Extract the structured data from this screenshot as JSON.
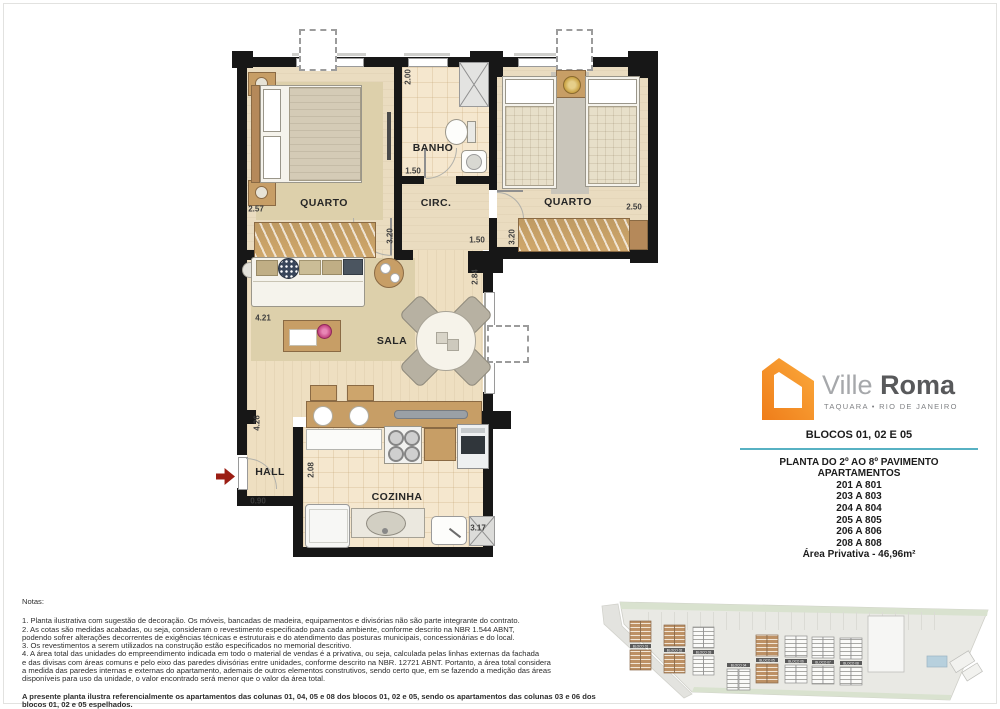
{
  "plan": {
    "rooms": {
      "quarto1": "QUARTO",
      "banho": "BANHO",
      "circ": "CIRC.",
      "quarto2": "QUARTO",
      "sala": "SALA",
      "hall": "HALL",
      "cozinha": "COZINHA"
    },
    "dims": {
      "q1_w": "2.57",
      "q1_h": "3.20",
      "banho_h": "2.00",
      "banho_w": "1.50",
      "circ_w": "1.50",
      "q2_w": "2.50",
      "q2_h": "3.20",
      "sala_h": "2.84",
      "sala_w": "4.21",
      "sala_left_h": "4.26",
      "hall_w": "0.90",
      "coz_h": "2.08",
      "coz_w": "3.17"
    }
  },
  "brand": {
    "name_light": "Ville",
    "name_bold": "Roma",
    "tagline": "TAQUARA • RIO DE JANEIRO",
    "logo_color": "#f6881f"
  },
  "info": {
    "blocks_title": "BLOCOS 01, 02 E 05",
    "accent_color": "#57b1c3",
    "title": "PLANTA DO 2º AO 8º PAVIMENTO",
    "subtitle": "APARTAMENTOS",
    "units": [
      "201 A 801",
      "203 A 803",
      "204 A 804",
      "205 A 805",
      "206 A 806",
      "208 A 808"
    ],
    "area": "Área Privativa - 46,96m²"
  },
  "notes": {
    "heading": "Notas:",
    "lines": [
      "1. Planta ilustrativa com sugestão de decoração. Os móveis, bancadas de madeira, equipamentos e divisórias não são parte integrante do contrato.",
      "2. As cotas são medidas acabadas, ou seja, consideram o revestimento especificado para cada ambiente, conforme descrito na NBR 1.544 ABNT,",
      "podendo sofrer alterações decorrentes de exigências técnicas e estruturais e do atendimento das posturas municipais, concessionárias e do local.",
      "3. Os revestimentos a serem utilizados na construção estão especificados no memorial descritivo.",
      "4. A área total das unidades do empreendimento indicada em todo o material de vendas é a privativa, ou seja, calculada pelas linhas externas da fachada",
      "e das divisas com áreas comuns e pelo eixo das paredes divisórias entre unidades, conforme descrito na NBR. 12721 ABNT. Portanto, a área total considera",
      "a medida das paredes internas e externas do apartamento, ademais de outros elementos construtivos, sendo certo que, em se fazendo a medição das áreas",
      "disponíveis para uso da unidade, o valor encontrado será menor que o valor da área total."
    ],
    "highlight": "A presente planta ilustra referencialmente os apartamentos das colunas 01, 04, 05 e 08 dos blocos 01, 02 e 05, sendo os apartamentos das colunas 03 e 06 dos blocos 01, 02 e 05 espelhados."
  },
  "site": {
    "blocks": [
      {
        "label": "BLOCO 01",
        "highlight": true
      },
      {
        "label": "BLOCO 02",
        "highlight": true
      },
      {
        "label": "BLOCO 03",
        "highlight": false
      },
      {
        "label": "BLOCO 04",
        "highlight": false
      },
      {
        "label": "BLOCO 05",
        "highlight": true
      },
      {
        "label": "BLOCO 06",
        "highlight": false
      },
      {
        "label": "BLOCO 07",
        "highlight": false
      },
      {
        "label": "BLOCO 08",
        "highlight": false
      }
    ]
  }
}
